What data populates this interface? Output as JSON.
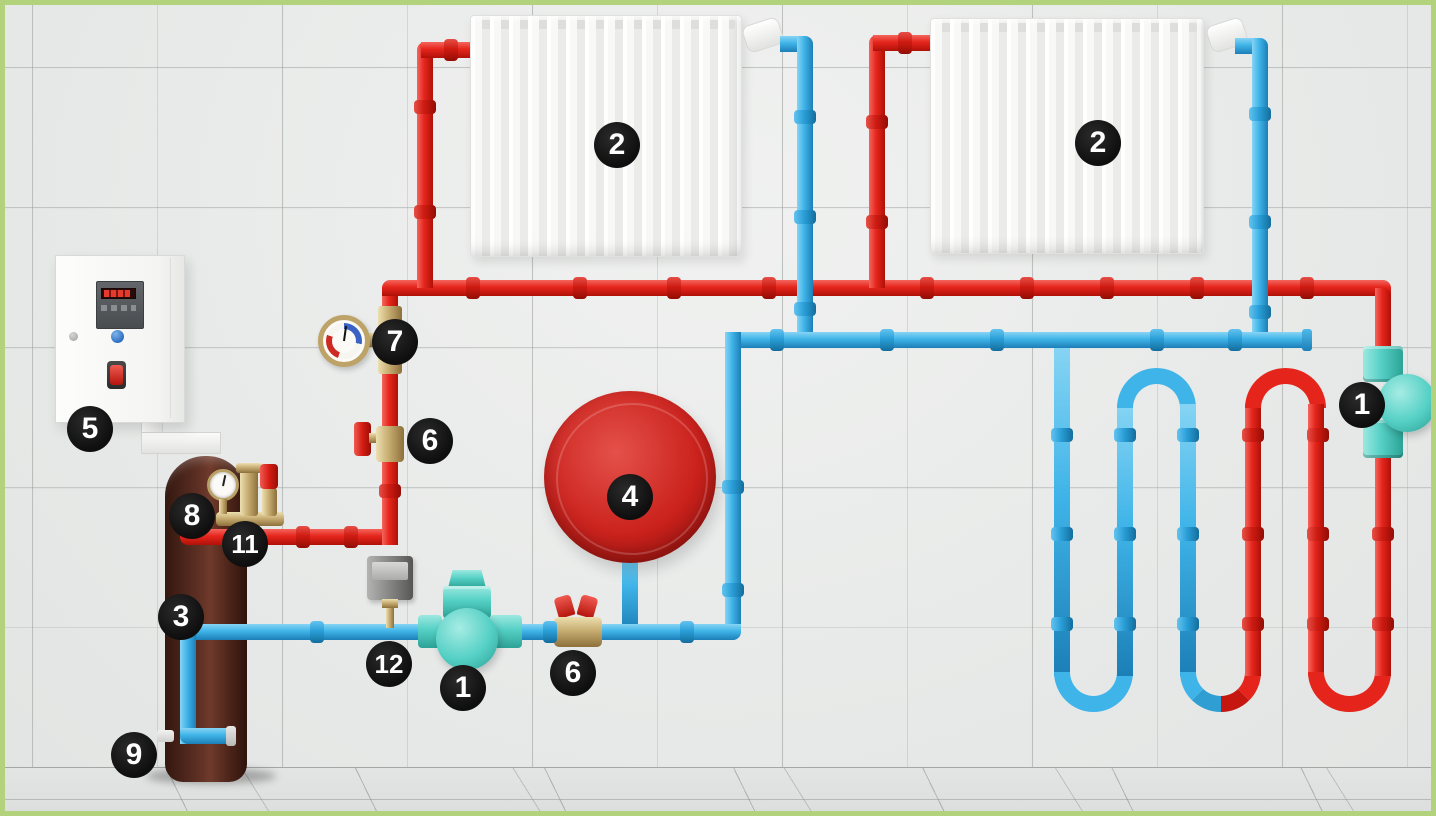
{
  "badges": {
    "circulation_pump_floor": "1",
    "circulation_pump_right": "1",
    "radiator_left": "2",
    "radiator_right": "2",
    "storage_tank": "3",
    "expansion_tank": "4",
    "control_panel": "5",
    "ball_valve_supply": "6",
    "ball_valve_return": "6",
    "thermomanometer": "7",
    "tank_gauge": "8",
    "drain_valve": "9",
    "safety_group_outlet": "11",
    "temperature_sensor": "12"
  },
  "colors": {
    "supply_pipe_red": "#e5251c",
    "return_pipe_blue": "#3fb4e8",
    "pump_teal": "#55d0c5",
    "brass_fitting": "#c7ad72",
    "tank_body_brown": "#5a2d23",
    "expansion_tank_red": "#cb221d",
    "frame_green": "#b2d37b",
    "badge_background": "#141414",
    "badge_text": "#ffffff"
  }
}
